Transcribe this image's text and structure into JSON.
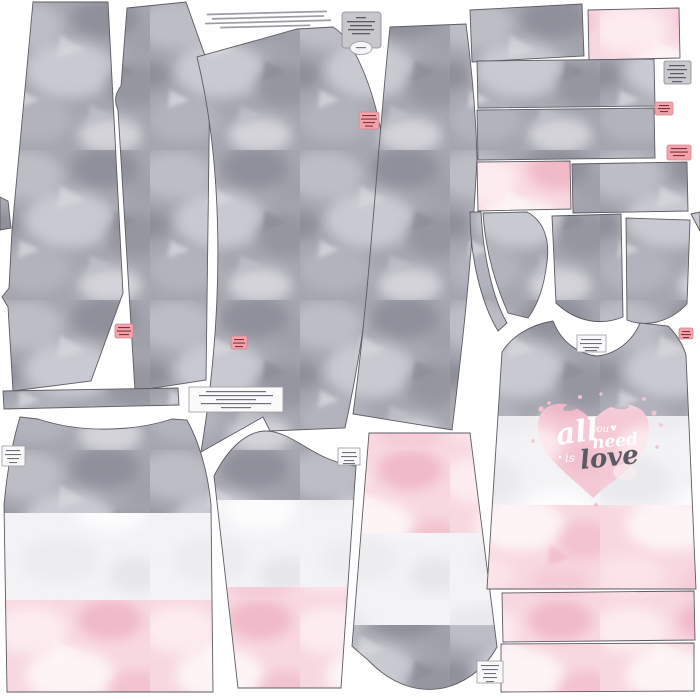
{
  "panel": {
    "width_px": 700,
    "height_px": 700,
    "background": "#ffffff",
    "kind": "sewing-pattern fabric printing panel preview"
  },
  "palette": {
    "camo_gray": "#a6a6b0",
    "camo_gray_light": "#c9c9d1",
    "camo_gray_dark": "#90909b",
    "camo_pink": "#f8d8e0",
    "camo_pink_light": "#fcebef",
    "fabric_white": "#f3f2f4",
    "heart_pink": "#f4c9d5",
    "outline": "#5b5b63",
    "label_gray_bg": "#c7c7cc",
    "label_pink_bg": "#f2a3ab",
    "label_pink_text": "#7d3039",
    "label_white_bg": "#fafafa",
    "heart_text_light": "#fdfdfd",
    "heart_text_dark": "#5a5a63"
  },
  "heart_graphic": {
    "word_all": "all",
    "word_you": "you",
    "word_need": "need",
    "word_is": "is",
    "word_love": "love",
    "heart_glyph": "♥"
  },
  "pieces": [
    {
      "name": "left-edge-cut-sliver",
      "fabric": "grey-camouflage"
    },
    {
      "name": "pant-leg-1",
      "fabric": "grey-camouflage"
    },
    {
      "name": "pant-leg-2",
      "fabric": "grey-camouflage"
    },
    {
      "name": "pant-leg-3",
      "fabric": "grey-camouflage"
    },
    {
      "name": "pant-leg-4",
      "fabric": "grey-camouflage"
    },
    {
      "name": "rect-gray-1",
      "fabric": "grey-camouflage"
    },
    {
      "name": "rect-pink-1",
      "fabric": "pink-watercolor"
    },
    {
      "name": "rect-gray-2",
      "fabric": "grey-camouflage"
    },
    {
      "name": "rect-gray-3",
      "fabric": "grey-camouflage"
    },
    {
      "name": "rect-pink-2",
      "fabric": "pink-watercolor"
    },
    {
      "name": "rect-gray-4",
      "fabric": "grey-camouflage"
    },
    {
      "name": "curved-facing",
      "fabric": "grey-camouflage"
    },
    {
      "name": "curved-binding-strip",
      "fabric": "grey-camouflage"
    },
    {
      "name": "cap-sleeve-left",
      "fabric": "grey-camouflage"
    },
    {
      "name": "cap-sleeve-right",
      "fabric": "grey-camouflage"
    },
    {
      "name": "right-edge-cut-piece",
      "fabric": "grey-camouflage"
    },
    {
      "name": "neckband-strip",
      "fabric": "grey-camouflage"
    },
    {
      "name": "tank-back-panel",
      "fabric": "grey-white-pink-stripes"
    },
    {
      "name": "sleeve-panel",
      "fabric": "grey-white-pink-stripes"
    },
    {
      "name": "sleeve-panel-inverted",
      "fabric": "pink-white-grey-stripes"
    },
    {
      "name": "tank-front-panel",
      "fabric": "grey-white-pink-stripes-with-heart"
    },
    {
      "name": "pink-strip-1",
      "fabric": "pink-watercolor"
    },
    {
      "name": "pink-strip-2",
      "fabric": "pink-watercolor"
    }
  ],
  "tags": {
    "gray_info_tags": 2,
    "pink_piece_tags": 6,
    "white_piece_tags": 5,
    "fine_print_lines": 4
  }
}
